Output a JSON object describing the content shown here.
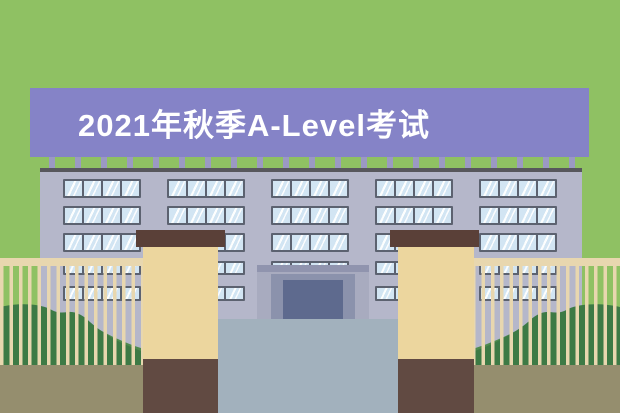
{
  "banner": {
    "text": "2021年秋季A-Level考试",
    "bg": "#8583c7",
    "text_color": "#ffffff"
  },
  "scene": {
    "background": "#8fc163",
    "building": {
      "wall": "#b5b7ca",
      "roofline": "#57575c",
      "parapet_post": "#9b99c3",
      "window_frame": "#5c6270",
      "window_glass": "#d2e5f3",
      "group_starts": [
        63,
        167,
        271,
        375,
        479
      ],
      "group_width": 78,
      "rows": [
        {
          "y": 179,
          "h": 19,
          "panes": 4
        },
        {
          "y": 206,
          "h": 19,
          "panes": 4
        },
        {
          "y": 233,
          "h": 19,
          "panes": 4
        },
        {
          "y": 261,
          "h": 14,
          "panes": 4
        },
        {
          "y": 286,
          "h": 15,
          "panes": 4
        }
      ]
    },
    "entrance": {
      "outer": "#a8abbf",
      "top_bar": "#9094ae",
      "mid": "#8b92ac",
      "door": "#5e6a8e"
    },
    "courtyard": "#a2b1bd",
    "pillar": {
      "cap": "#5a4038",
      "body": "#ecd69e",
      "base": "#614a42"
    },
    "fence": {
      "color": "#e8d7af",
      "bar_width": 3.5,
      "bar_period": 9.4
    },
    "bush": {
      "back": "#4f8b4d",
      "front": "#3d7a45"
    },
    "ground": "#958e6e"
  }
}
